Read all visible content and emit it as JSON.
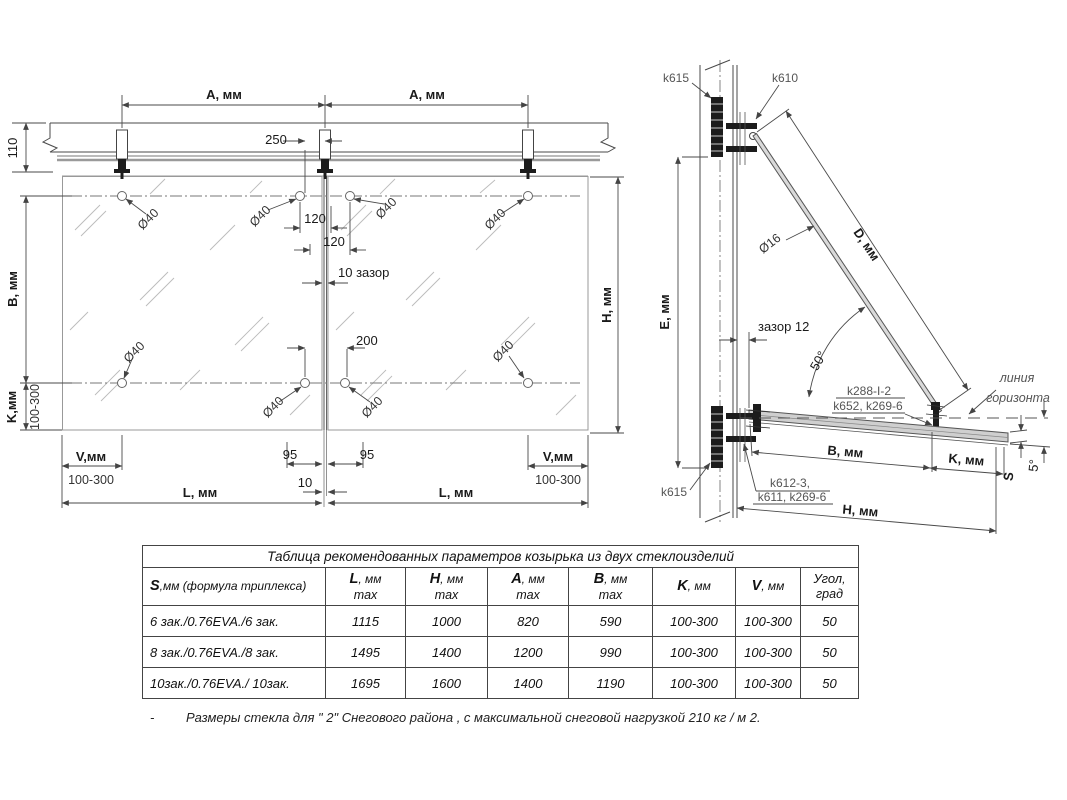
{
  "front_view": {
    "dims": {
      "a1": "A, мм",
      "a2": "A, мм",
      "d110": "110",
      "d250": "250",
      "d120a": "120",
      "d120b": "120",
      "gap10": "10 зазор",
      "d200": "200",
      "d95a": "95",
      "d95b": "95",
      "d10": "10",
      "b": "B, мм",
      "k": "K,мм",
      "k_range": "100-300",
      "v_left": "V,мм",
      "v_left_range": "100-300",
      "v_right": "V,мм",
      "v_right_range": "100-300",
      "l_left": "L,  мм",
      "l_right": "L,  мм",
      "h": "H, мм"
    },
    "holes": {
      "h1": "Ø40",
      "h2": "Ø40",
      "h3": "Ø40",
      "h4": "Ø40",
      "h5": "Ø40",
      "h6": "Ø40",
      "h7": "Ø40",
      "h8": "Ø40"
    }
  },
  "side_view": {
    "k615_top": "k615",
    "k610": "k610",
    "dim_d": "D, мм",
    "dia16": "Ø16",
    "dim_e": "E, мм",
    "gap12": "зазор 12",
    "angle50": "50°",
    "k288": "k288-I-2",
    "k652": "k652, k269-6",
    "horizon1": "линия",
    "horizon2": "горизонта",
    "dim_b": "B, мм",
    "dim_k": "K, мм",
    "dim_s": "S",
    "angle5": "5°",
    "dim_h": "H, мм",
    "k612": "k612-3,",
    "k611": "k611, k269-6",
    "k615_bottom": "k615"
  },
  "table": {
    "title": "Таблица рекомендованных параметров  козырька из двух стеклоизделий",
    "columns": [
      {
        "sym": "S",
        "unit": ",мм (формула триплекса)",
        "sub": ""
      },
      {
        "sym": "L",
        "unit": ", мм",
        "sub": "max"
      },
      {
        "sym": "H",
        "unit": ", мм",
        "sub": "max"
      },
      {
        "sym": "A",
        "unit": ", мм",
        "sub": "max"
      },
      {
        "sym": "B",
        "unit": ", мм",
        "sub": "max"
      },
      {
        "sym": "K",
        "unit": ", мм",
        "sub": ""
      },
      {
        "sym": "V",
        "unit": ", мм",
        "sub": ""
      },
      {
        "sym": "Угол",
        "unit": ",",
        "sub": "град"
      }
    ],
    "rows": [
      [
        "6 зак./0.76EVA./6 зак.",
        "1115",
        "1000",
        "820",
        "590",
        "100-300",
        "100-300",
        "50"
      ],
      [
        "8 зак./0.76EVA./8 зак.",
        "1495",
        "1400",
        "1200",
        "990",
        "100-300",
        "100-300",
        "50"
      ],
      [
        "10зак./0.76EVA./ 10зак.",
        "1695",
        "1600",
        "1400",
        "1190",
        "100-300",
        "100-300",
        "50"
      ]
    ]
  },
  "note": {
    "dash": "-",
    "text": "Размеры стекла  для  \" 2\"  Снегового района ,  с максимальной снеговой нагрузкой  210 кг / м 2."
  }
}
